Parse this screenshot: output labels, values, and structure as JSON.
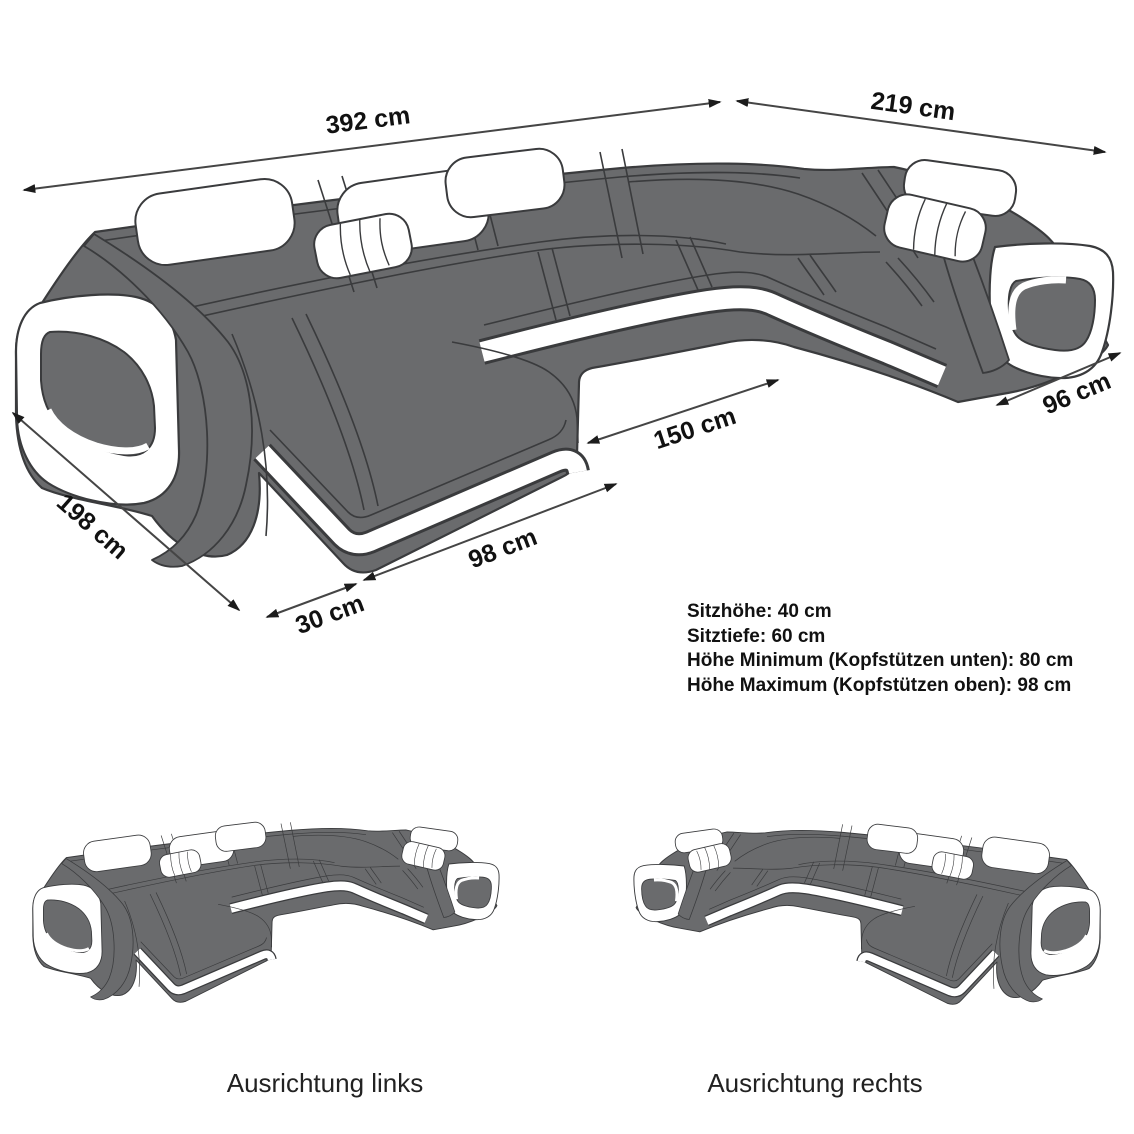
{
  "diagram": {
    "dims": {
      "total_width": "392 cm",
      "right_depth": "219 cm",
      "inner_width": "150 cm",
      "right_end_width": "96 cm",
      "left_depth": "198 cm",
      "chaise_front_width": "98 cm",
      "armrest_front_width": "30 cm"
    },
    "specs": [
      "Sitzhöhe: 40 cm",
      "Sitztiefe: 60 cm",
      "Höhe Minimum (Kopfstützen unten): 80 cm",
      "Höhe Maximum (Kopfstützen oben): 98 cm"
    ],
    "variants": [
      "Ausrichtung links",
      "Ausrichtung rechts"
    ],
    "colors": {
      "sofa_gray": "#6a6b6d",
      "outline": "#3a3b3d",
      "accent_white": "#ffffff",
      "dimension_line": "#454545",
      "text": "#111111"
    }
  }
}
